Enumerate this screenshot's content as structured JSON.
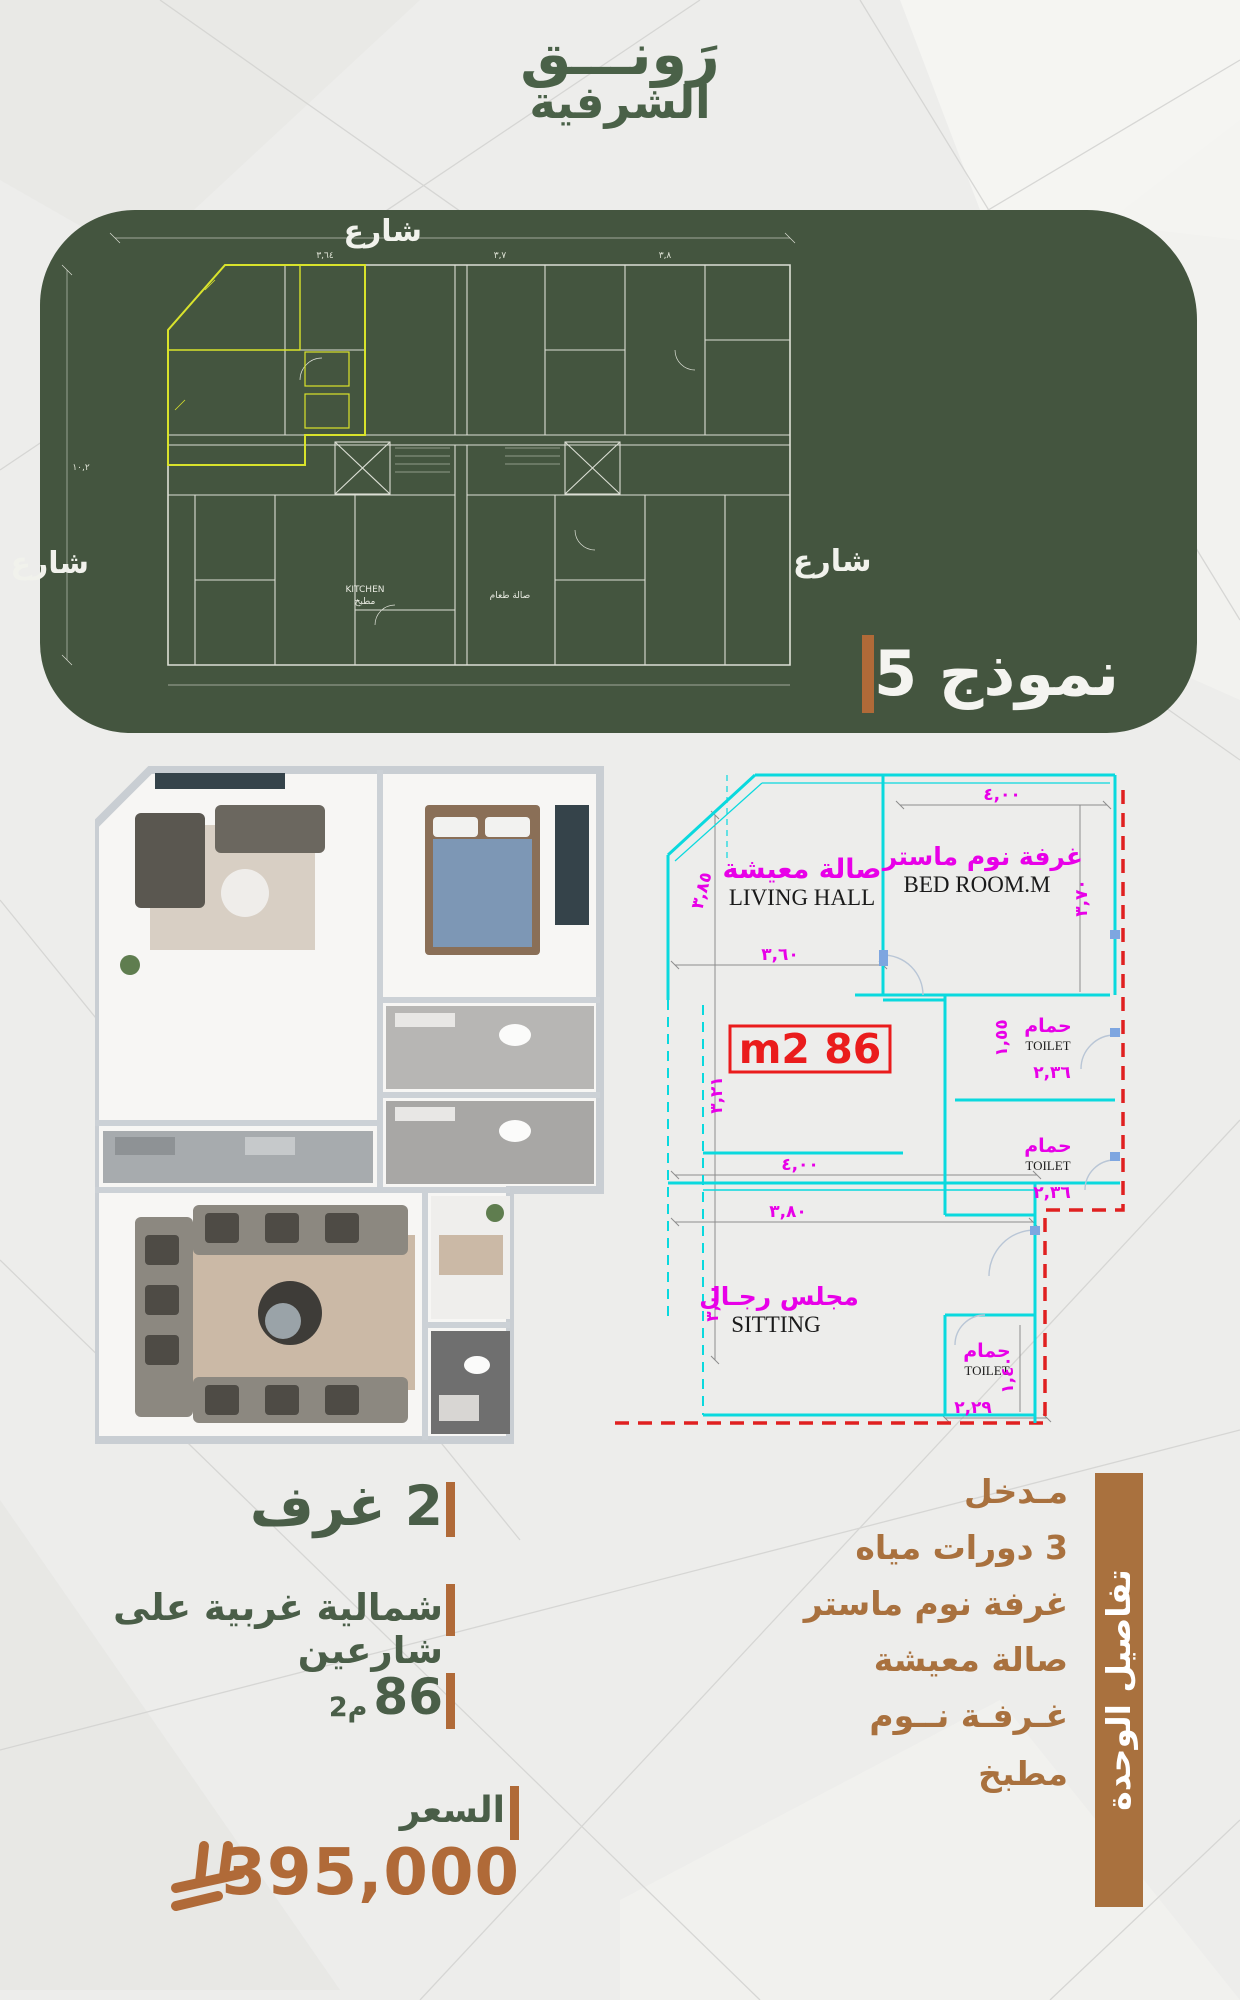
{
  "logo": {
    "line1": "رَونـــق",
    "line2": "الشرفية"
  },
  "panel": {
    "street_top": "شارع",
    "street_left": "شارع",
    "street_right": "شارع",
    "model_label": "نموذج 5",
    "building_b": "مبنى B",
    "neighbor": "جار",
    "building_a": "مبنى A",
    "plan_kitchen_en": "KITCHEN",
    "plan_kitchen_ar": "مطبخ",
    "plan_dining_ar": "صالة طعام"
  },
  "cad": {
    "living_ar": "صالة معيشة",
    "living_en": "LIVING  HALL",
    "master_ar": "غرفة نوم ماستر",
    "master_en": "BED  ROOM.M",
    "toilet_ar": "حمام",
    "toilet_en": "TOILET",
    "sitting_ar": "مجلس رجـال",
    "sitting_en": "SITTING",
    "area_badge": "86 m2",
    "dims": {
      "d400a": "٤,٠٠",
      "d385": "٣,٨٥",
      "d360": "٣,٦٠",
      "d370": "٣,٧٠",
      "d155": "١,٥٥",
      "d236a": "٢,٣٦",
      "d236b": "٢,٣٦",
      "d321": "٣,٢١",
      "d400b": "٤,٠٠",
      "d380": "٣,٨٠",
      "d300": "٣,٠٠",
      "d229": "٢,٢٩",
      "d140": "١,٤٠"
    }
  },
  "details": {
    "rooms": "2 غرف",
    "orientation": "شمالية غربية على شارعين",
    "area_value": "86",
    "area_unit": "م2",
    "price_label": "السعر",
    "price": "395,000"
  },
  "sidebar": {
    "title": "تفاصيل الوحدة",
    "items": [
      "مـدخل",
      "3 دورات مياه",
      "غرفة نوم ماستر",
      "صالة معيشة",
      "غـرفـة نــوم",
      "مطبخ"
    ]
  },
  "colors": {
    "panel_green": "#44553f",
    "accent_orange": "#b06a38",
    "sidebar_brown": "#a9713e",
    "highlight_yellow": "#d9e32b",
    "cad_cyan": "#0ad9de",
    "cad_magenta": "#e800e8",
    "area_red": "#ea1c1c"
  }
}
